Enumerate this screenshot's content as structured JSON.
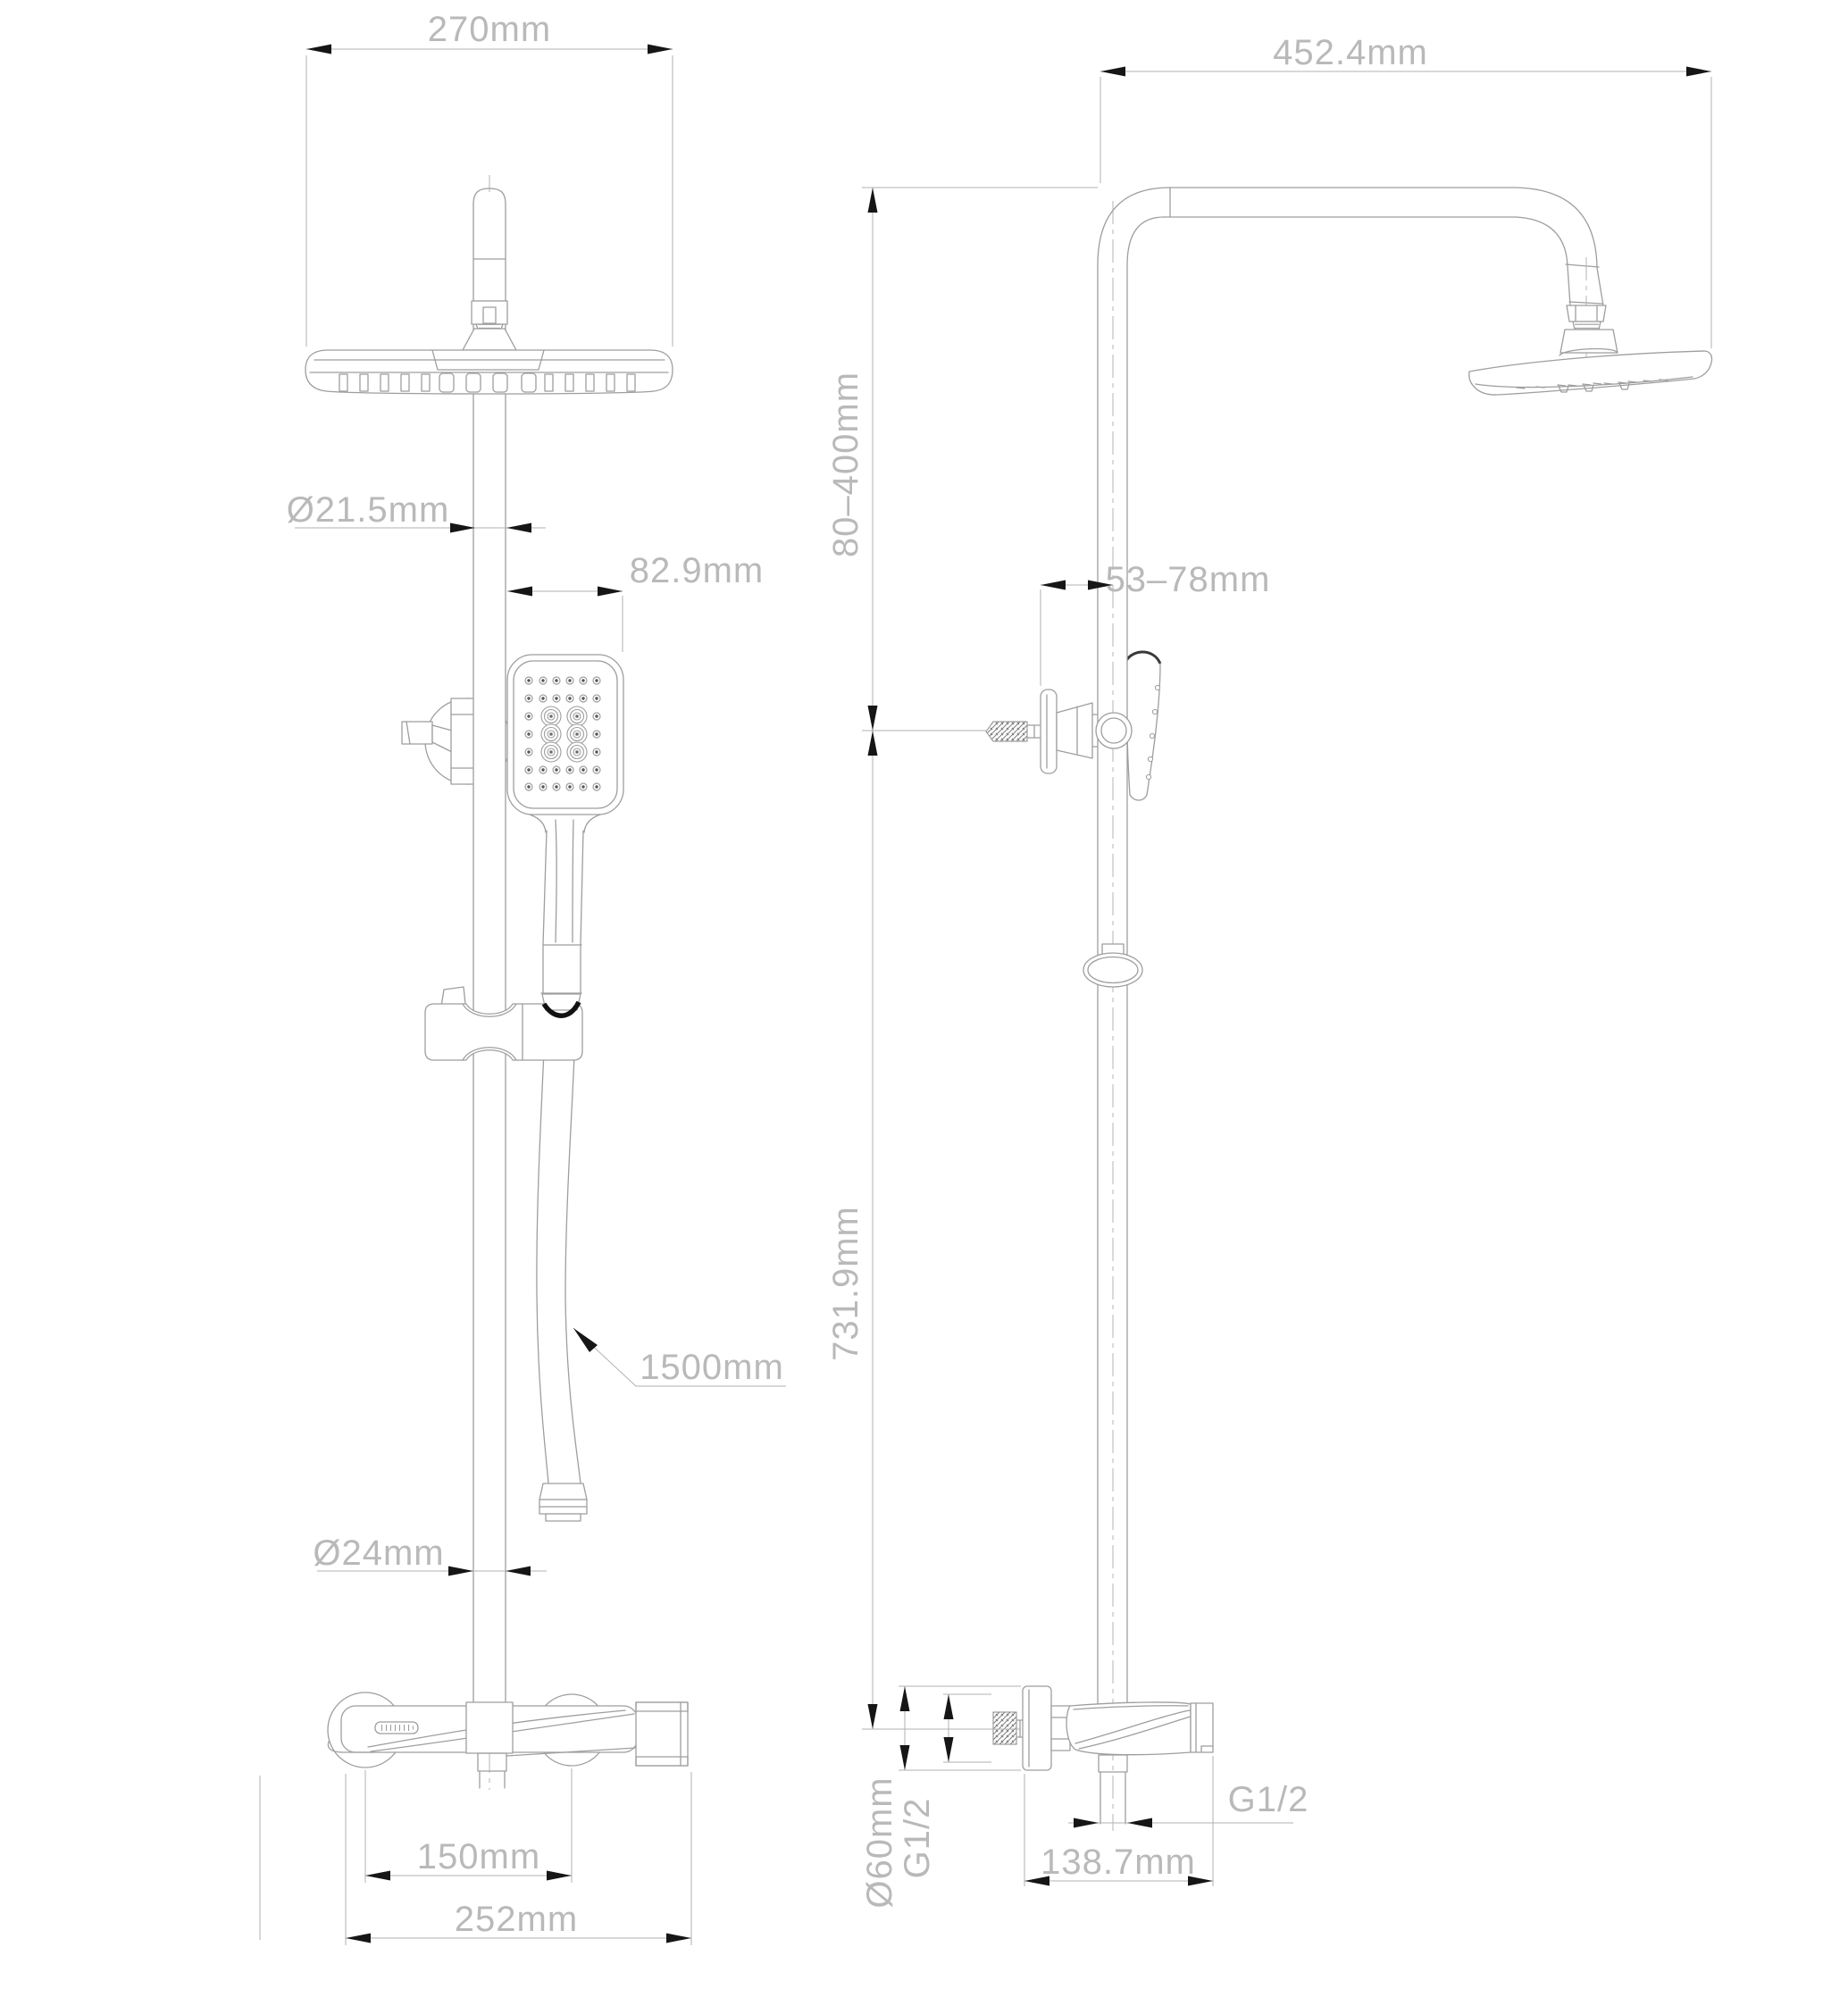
{
  "views": {
    "front": {
      "dimensions": {
        "head_width": "270mm",
        "pipe_upper_diameter": "Ø21.5mm",
        "handshower_offset": "82.9mm",
        "hose_length": "1500mm",
        "pipe_lower_diameter": "Ø24mm",
        "inlet_center_distance": "150mm",
        "mixer_width": "252mm"
      }
    },
    "side": {
      "dimensions": {
        "arm_reach": "452.4mm",
        "bracket_height_range": "80–400mm",
        "bracket_offset_range": "53–78mm",
        "riser_length": "731.9mm",
        "flange_diameter": "Ø60mm",
        "inlet_thread": "G1/2",
        "outlet_thread": "G1/2",
        "mixer_depth": "138.7mm"
      }
    }
  },
  "colors": {
    "background": "#ffffff",
    "part_line": "#9e9e9e",
    "dimension_line": "#b2b2b2",
    "dimension_text": "#b9b9b9",
    "arrowhead": "#161616"
  }
}
